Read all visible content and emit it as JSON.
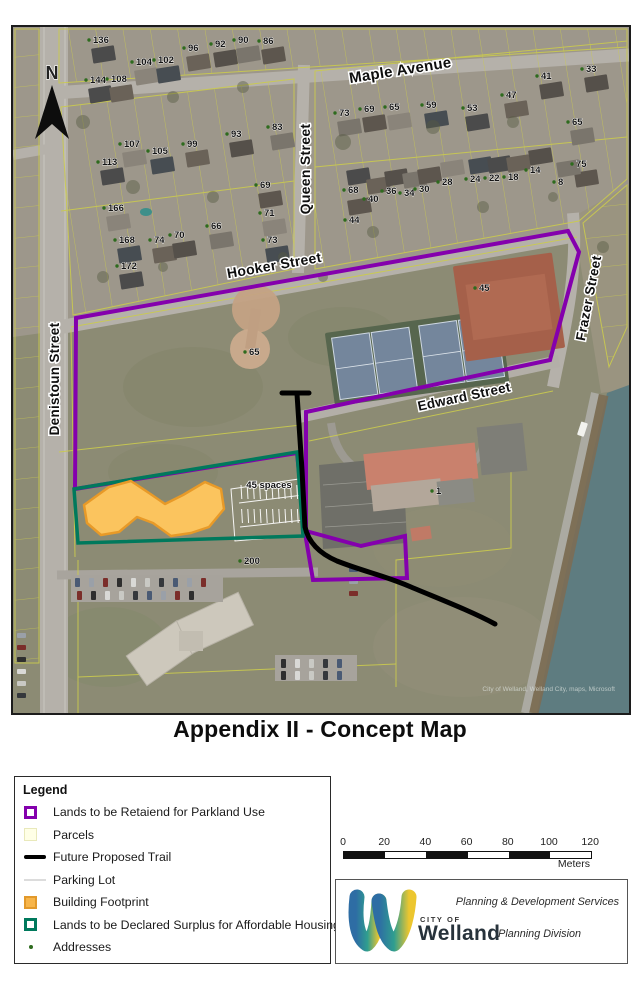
{
  "page": {
    "title": "Appendix II - Concept Map"
  },
  "colors": {
    "parkland_purple": "#8400ad",
    "surplus_green": "#00795c",
    "building_orange_fill": "#fbc45e",
    "building_orange_border": "#e89a28",
    "parcel_yellow": "#cbcb4e",
    "trail_black": "#000000",
    "address_dot_green": "#2e6b1e",
    "water": "#5e7c80"
  },
  "legend": {
    "header": "Legend",
    "items": [
      {
        "label": "Lands to be Retaiend for Parkland Use"
      },
      {
        "label": "Parcels"
      },
      {
        "label": "Future Proposed Trail"
      },
      {
        "label": "Parking Lot"
      },
      {
        "label": "Building Footprint"
      },
      {
        "label": "Lands to be Declared Surplus for Affordable Housing"
      },
      {
        "label": "Addresses"
      }
    ]
  },
  "scale": {
    "ticks": [
      "0",
      "20",
      "40",
      "60",
      "80",
      "100",
      "120"
    ],
    "unit": "Meters"
  },
  "logo": {
    "city_of": "CITY OF",
    "city": "Welland",
    "line1": "Planning & Development Services",
    "line2": "Planning Division"
  },
  "map": {
    "north_label": "N",
    "annotation_parking": "45 spaces",
    "attribution": "City of Welland, Welland City, maps, Microsoft",
    "streets": [
      {
        "name": "Maple Avenue",
        "x": 388,
        "y": 48,
        "rot": -9,
        "size": 15
      },
      {
        "name": "Queen Street",
        "x": 297,
        "y": 142,
        "rot": -90,
        "size": 14
      },
      {
        "name": "Hooker Street",
        "x": 262,
        "y": 243,
        "rot": -10,
        "size": 14
      },
      {
        "name": "Edward Street",
        "x": 452,
        "y": 374,
        "rot": -12,
        "size": 13.5
      },
      {
        "name": "Frazer Street",
        "x": 580,
        "y": 272,
        "rot": -79,
        "size": 13.5
      },
      {
        "name": "Denistoun Street",
        "x": 46,
        "y": 352,
        "rot": -90,
        "size": 13.5
      }
    ],
    "addresses": [
      {
        "n": "136",
        "x": 80,
        "y": 8
      },
      {
        "n": "96",
        "x": 175,
        "y": 16
      },
      {
        "n": "92",
        "x": 202,
        "y": 12
      },
      {
        "n": "90",
        "x": 225,
        "y": 8
      },
      {
        "n": "86",
        "x": 250,
        "y": 9
      },
      {
        "n": "104",
        "x": 123,
        "y": 30
      },
      {
        "n": "102",
        "x": 145,
        "y": 28
      },
      {
        "n": "144",
        "x": 77,
        "y": 48
      },
      {
        "n": "108",
        "x": 98,
        "y": 47
      },
      {
        "n": "33",
        "x": 573,
        "y": 37
      },
      {
        "n": "73",
        "x": 326,
        "y": 81
      },
      {
        "n": "69",
        "x": 351,
        "y": 77
      },
      {
        "n": "65",
        "x": 376,
        "y": 75
      },
      {
        "n": "59",
        "x": 413,
        "y": 73
      },
      {
        "n": "53",
        "x": 454,
        "y": 76
      },
      {
        "n": "47",
        "x": 493,
        "y": 63
      },
      {
        "n": "41",
        "x": 528,
        "y": 44
      },
      {
        "n": "65",
        "x": 559,
        "y": 90
      },
      {
        "n": "75",
        "x": 563,
        "y": 132
      },
      {
        "n": "107",
        "x": 111,
        "y": 112
      },
      {
        "n": "105",
        "x": 139,
        "y": 119
      },
      {
        "n": "113",
        "x": 89,
        "y": 130
      },
      {
        "n": "99",
        "x": 174,
        "y": 112
      },
      {
        "n": "93",
        "x": 218,
        "y": 102
      },
      {
        "n": "83",
        "x": 259,
        "y": 95
      },
      {
        "n": "69",
        "x": 247,
        "y": 153
      },
      {
        "n": "71",
        "x": 251,
        "y": 181
      },
      {
        "n": "73",
        "x": 254,
        "y": 208
      },
      {
        "n": "68",
        "x": 335,
        "y": 158
      },
      {
        "n": "40",
        "x": 355,
        "y": 167
      },
      {
        "n": "36",
        "x": 373,
        "y": 159
      },
      {
        "n": "34",
        "x": 391,
        "y": 161
      },
      {
        "n": "30",
        "x": 406,
        "y": 157
      },
      {
        "n": "28",
        "x": 429,
        "y": 150
      },
      {
        "n": "24",
        "x": 457,
        "y": 147
      },
      {
        "n": "22",
        "x": 476,
        "y": 146
      },
      {
        "n": "18",
        "x": 495,
        "y": 145
      },
      {
        "n": "14",
        "x": 517,
        "y": 138
      },
      {
        "n": "8",
        "x": 545,
        "y": 150
      },
      {
        "n": "44",
        "x": 336,
        "y": 188
      },
      {
        "n": "166",
        "x": 95,
        "y": 176
      },
      {
        "n": "168",
        "x": 106,
        "y": 208
      },
      {
        "n": "172",
        "x": 108,
        "y": 234
      },
      {
        "n": "74",
        "x": 141,
        "y": 208
      },
      {
        "n": "70",
        "x": 161,
        "y": 203
      },
      {
        "n": "66",
        "x": 198,
        "y": 194
      },
      {
        "n": "45",
        "x": 466,
        "y": 256
      },
      {
        "n": "65",
        "x": 236,
        "y": 320
      },
      {
        "n": "1",
        "x": 423,
        "y": 459
      },
      {
        "n": "200",
        "x": 231,
        "y": 529
      }
    ]
  }
}
